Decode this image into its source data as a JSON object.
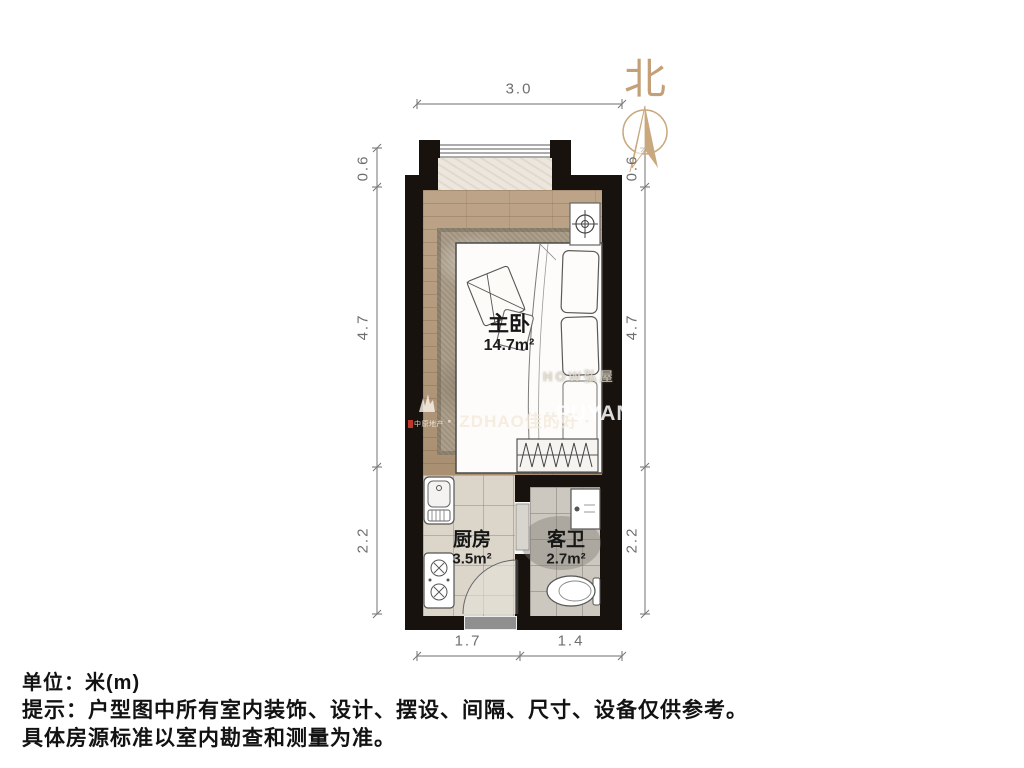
{
  "compass": {
    "label": "北"
  },
  "rooms": {
    "bedroom": {
      "name": "主卧",
      "area": "14.7m²"
    },
    "kitchen": {
      "name": "厨房",
      "area": "3.5m²"
    },
    "bathroom": {
      "name": "客卫",
      "area": "2.7m²"
    }
  },
  "dimensions": {
    "top": "3.0",
    "bottom_left": "1.7",
    "bottom_right": "1.4",
    "left_top": "0.6",
    "left_middle": "4.7",
    "left_bottom": "2.2",
    "right_top": "0.6",
    "right_middle": "4.7",
    "right_bottom": "2.2"
  },
  "watermarks": {
    "faint_text": "HOW弘屋",
    "logo_text": "中原地产",
    "brand_center": "ZDHAO佳的好",
    "brand_right": "PUYAN",
    "separator": "·"
  },
  "footer": {
    "unit_line": "单位：米(m)",
    "note_line1": "提示：户型图中所有室内装饰、设计、摆设、间隔、尺寸、设备仅供参考。",
    "note_line2": "具体房源标准以室内勘查和测量为准。"
  },
  "colors": {
    "wall": "#17120e",
    "wood_floor": "#b49878",
    "kitchen_floor": "#dbd5ca",
    "bath_floor": "#ccc7bf",
    "north_accent": "#c3a078",
    "dimension_text": "#6e6e6e",
    "entry_door": "#8f8f8f"
  }
}
